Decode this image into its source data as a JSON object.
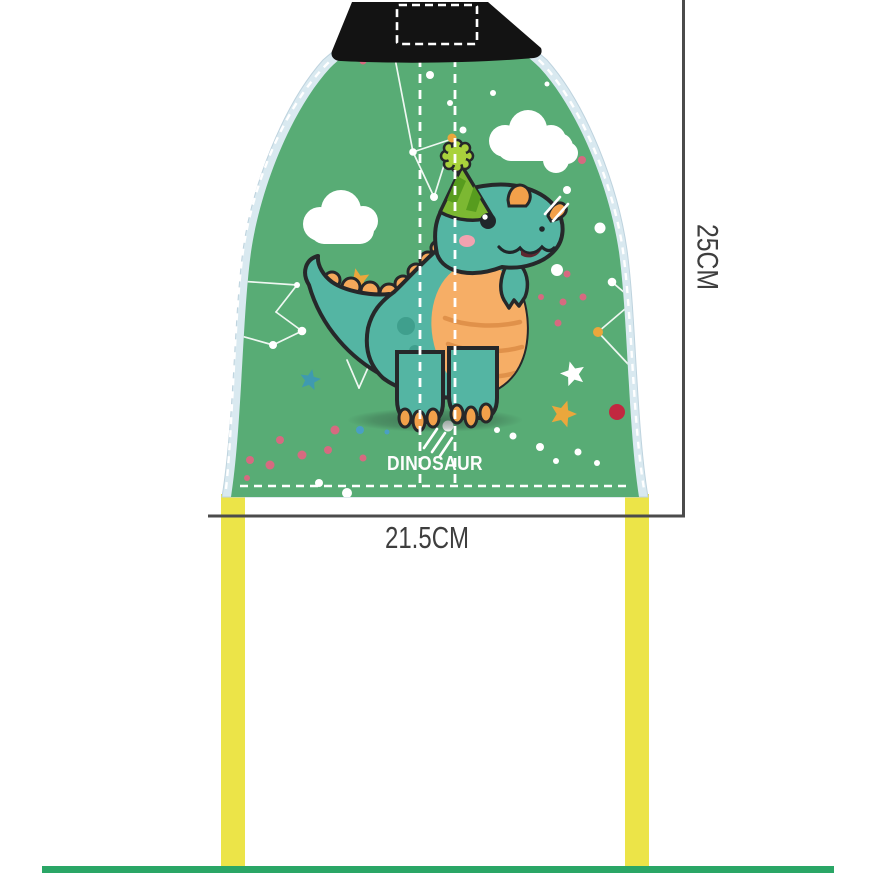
{
  "annotations": {
    "height_dimension": "25CM",
    "width_dimension": "21.5CM"
  },
  "canopy": {
    "brand_label": "DINOSAUR"
  },
  "colors": {
    "canopy_green": "#58ac75",
    "canopy_border_blue": "#d9e9f0",
    "top_strap_black": "#131313",
    "elastic_band_yellow": "#ece448",
    "bottom_bar_green": "#2aa666",
    "dimension_line_gray": "#4b4b4b",
    "dino_body_teal": "#54b5a3",
    "dino_belly_orange": "#f6ae66",
    "dino_spike_orange": "#f5a85a",
    "party_hat_green": "#7cb832",
    "pompom_green": "#a9d23c",
    "confetti_pink": "#d66a80",
    "confetti_red": "#c22840",
    "confetti_gold": "#eba73c",
    "confetti_blue": "#4a9fc4",
    "star_blue": "#3f9ab0"
  }
}
